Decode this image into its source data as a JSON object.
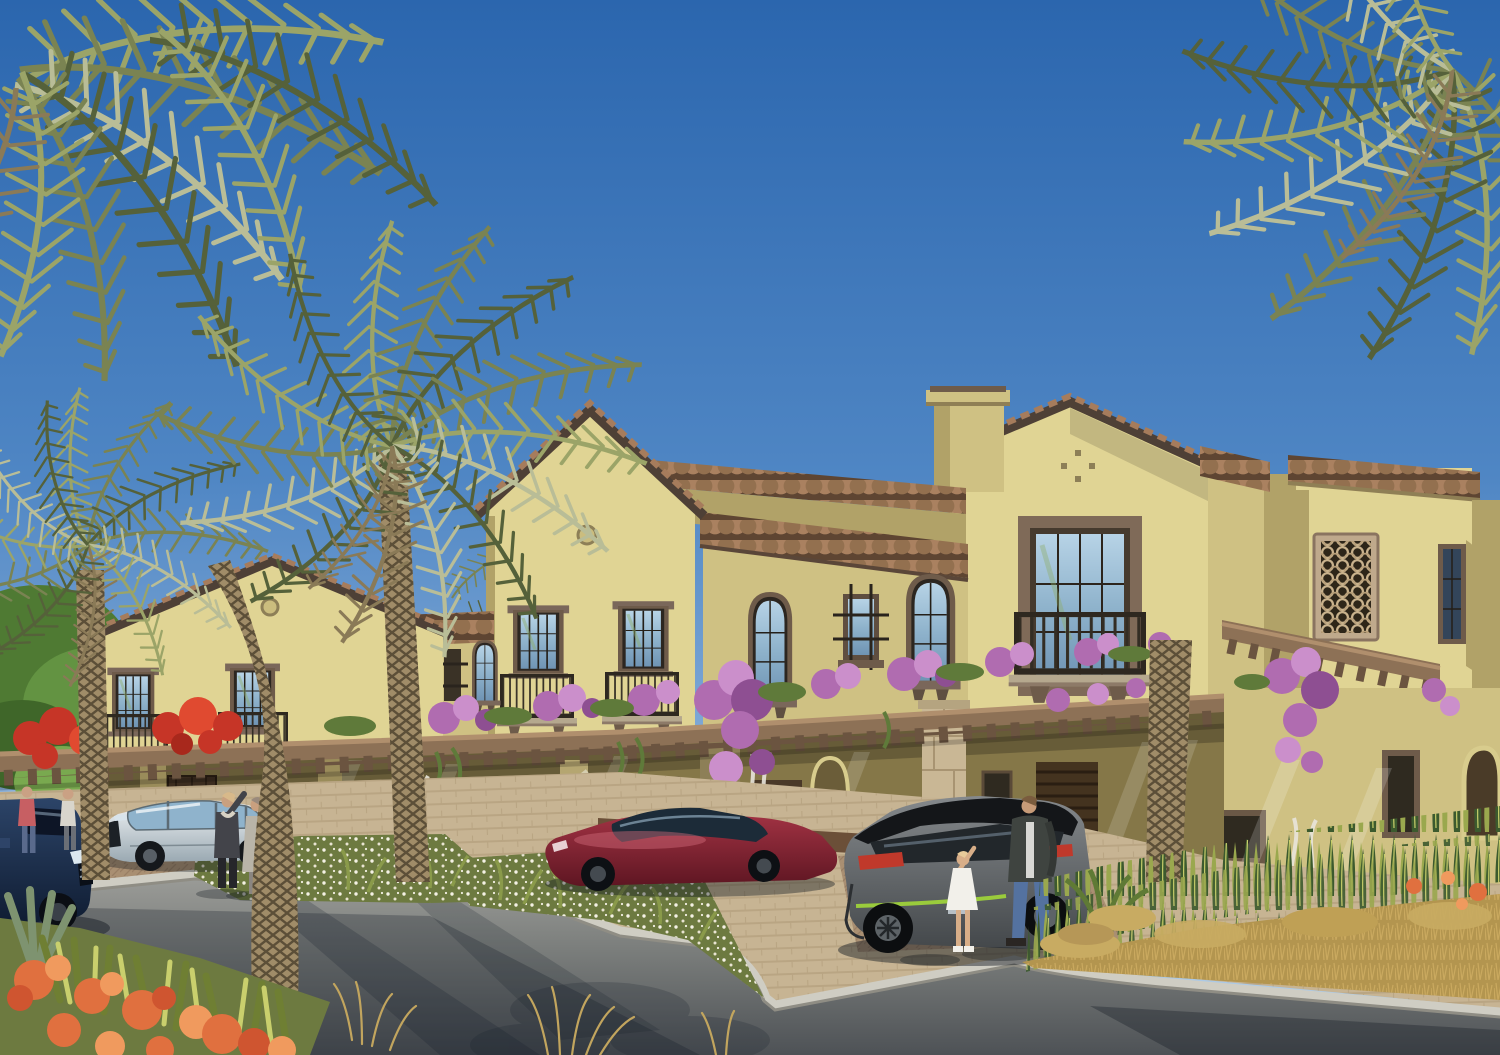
{
  "meta": {
    "title": "Mediterranean Townhouses — Exterior Rendering",
    "description": "Photorealistic architectural rendering of a row of two-storey sand-coloured Mediterranean townhouses with terracotta tile eaves, wrought-iron Juliet balconies, arched windows, a latticed tower screen and a long timber pergola draped in purple and red bougainvillea. Date palms frame a curved asphalt street with granite kerbs, sandy paver driveways, beds of white flowers, snake plants, golden grasses and orange blossoms. A navy SUV, a silver crossover, a dark-red sports car and a grey SUV are parked; residents stroll and a child points up beside the grey SUV under a clear blue sky.",
    "time_of_day": "midday, clear sunny sky",
    "style": "3D architectural visualisation"
  },
  "scene": {
    "sky": {
      "condition": "clear",
      "gradient_top": "#2b66ae",
      "gradient_horizon": "#b9d3ea"
    },
    "architecture": {
      "type": "two-storey Mediterranean / Andalusian townhouse terrace",
      "walls": "sand-yellow stucco",
      "features": [
        "terracotta scalloped tile eaves",
        "gabled roofs with circular medallions",
        "chimney stack",
        "wrought-iron Juliet balconies",
        "arched upper windows",
        "decorative iron window grilles",
        "latticed mashrabiya tower screen",
        "timber pergola with rafter tails",
        "stone pergola columns",
        "dark timber doors and louvred garage gates",
        "arched side doorway"
      ]
    },
    "vegetation": {
      "palms": {
        "count": 4,
        "type": "date palms",
        "notes": "crowns enter from both top corners, one full palm at left, one tall palm at centre"
      },
      "bougainvillea": {
        "purple_clusters": 10,
        "red_clusters": 2
      },
      "beds": [
        "white flower island beds",
        "snake-plant and golden grass verge at right",
        "orange ixora and agave bed at front left",
        "stray dry grass wisps over the road edge"
      ]
    },
    "vehicles": [
      {
        "name": "navy-suv",
        "body_color": "#1d2c49",
        "position": "far left, cropped by frame"
      },
      {
        "name": "silver-crossover",
        "body_color": "#dde6ea",
        "position": "parked left of centre"
      },
      {
        "name": "dark-red-sports-car",
        "body_color": "#8e2738",
        "position": "parked at centre"
      },
      {
        "name": "grey-suv",
        "body_color": "#63686c",
        "accent_color": "#9acb3c",
        "position": "parked right of centre"
      }
    ],
    "people": [
      {
        "name": "resident-in-pink",
        "position": "far left near red bougainvillea"
      },
      {
        "name": "resident-in-white",
        "position": "far left behind hedge"
      },
      {
        "name": "waving-woman",
        "position": "centre-left walkway"
      },
      {
        "name": "woman-with-shopping-bag",
        "position": "centre-left walkway"
      },
      {
        "name": "man-in-dark-coat",
        "position": "beside grey SUV"
      },
      {
        "name": "girl-in-white-dress",
        "position": "pointing up beside grey SUV"
      }
    ],
    "ground": {
      "road": "curved dark asphalt with palm shadows",
      "kerb": "light granite",
      "paving": "sand-coloured pavers with brown herringbone parking strips"
    }
  },
  "colors": {
    "sky-top": "#2b66ae",
    "sky-mid": "#5d92cb",
    "sky-low": "#b9d3ea",
    "wall-light": "#e0d494",
    "wall-mid": "#cfc183",
    "wall-shade": "#b1a268",
    "wall-ground": "#857748",
    "fascia": "#4e4036",
    "tile-light": "#a87f5e",
    "tile-dark": "#5e4532",
    "frame": "#6e5b4a",
    "glass-hi": "#b7d3e6",
    "glass-lo": "#6f94b4",
    "rail": "#332d24",
    "pergola": "#8d7156",
    "pergola-dark": "#6b5440",
    "boug": "#b06cb0",
    "boug-light": "#cb8fcb",
    "boug-deep": "#8e4f92",
    "boug-red": "#c63527",
    "leaf": "#5f7a3a",
    "palm-green": "#7a8352",
    "palm-light": "#9ba468",
    "palm-dark": "#55613a",
    "palm-silver": "#b9bd97",
    "palm-dry": "#8a7a57",
    "trunk": "#a08c68",
    "trunk-line": "#5c4f38",
    "paver": "#c7b493",
    "paver-line": "#ab9573",
    "drive": "#a98f72",
    "road-hi": "#9a9b97",
    "road-lo": "#4e5256",
    "curb": "#cfcdc3",
    "bed-green": "#6d7a40",
    "grass-gold": "#b3954f",
    "snake-dark": "#3c5a2e",
    "snake-light": "#9aa84e",
    "orange": "#e0703f",
    "orange-light": "#f09a5e",
    "stone": "#c9b795"
  }
}
